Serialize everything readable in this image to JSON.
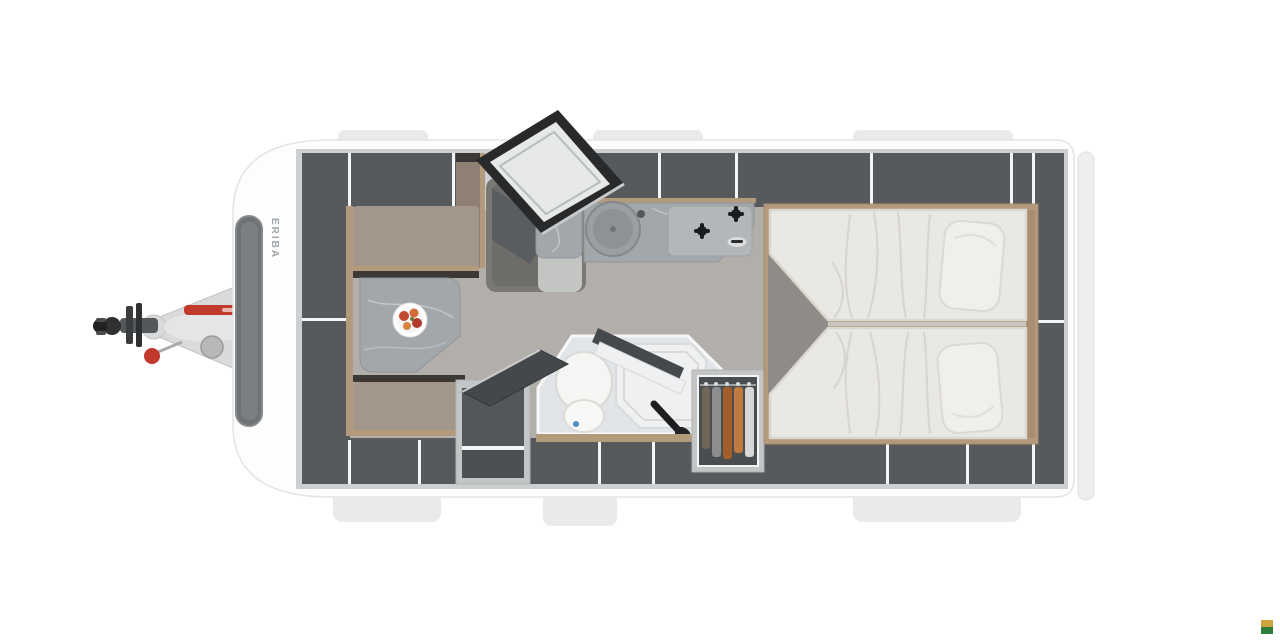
{
  "page": {
    "background": "#ffffff"
  },
  "floorplan": {
    "brand_label": "ERIBA",
    "colors": {
      "page_bg": "#ffffff",
      "body": "#fdfdfd",
      "body_edge": "#e2e4e5",
      "tab": "#e9eaeb",
      "wall": "#cdd0d1",
      "locker": "#565a5c",
      "locker_dark": "#4a4e50",
      "floor": "#b2afaa",
      "floor_dark": "#8f8c88",
      "mat": "#6f6d69",
      "seat": "#a3968a",
      "seat_dark": "#8e8174",
      "wood": "#b49a7d",
      "wood_dark": "#a98e70",
      "table": "#a2a7ab",
      "mattress": "#eae8e2",
      "pillow": "#f1efeb",
      "bath": "#e2e5e7",
      "tray": "#eef0f1",
      "porcelain": "#f5f5f3",
      "door": "#27292b",
      "divider": "#f4f5f5",
      "red": "#c0392b",
      "blue_dot": "#4a90c4",
      "clothes_brown": "#a35c2a",
      "clothes_tan": "#c07a3e",
      "clothes_gray": "#8b8d8f",
      "clothes_olive": "#6f6658",
      "clothes_white": "#d8d8d6",
      "badge_top": "#d0a43c",
      "badge_bottom": "#2f7d3c"
    },
    "icons": {
      "brand_badge": "two-tone-square",
      "hitch": "tow-coupling",
      "door": "entry-door-open",
      "plate": "food-plate"
    }
  }
}
